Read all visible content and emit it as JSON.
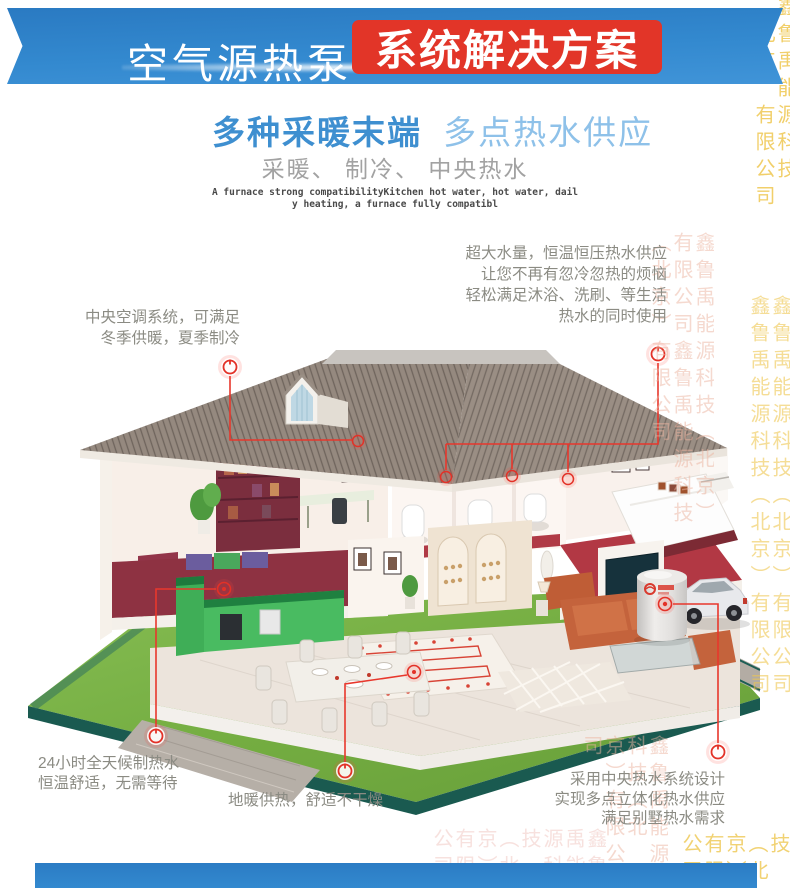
{
  "banner": {
    "title_thin": "空气源热泵",
    "title_badge": "系统解决方案"
  },
  "heading": {
    "line1_bold": "多种采暖末端",
    "line1_light": "多点热водs供应",
    "line2": "采暖、 制冷、 中央热水",
    "english_line1": "A furnace strong compatibilityKitchen hot water, hot water, dail",
    "english_line2": "y heating, a furnace fully compatibl"
  },
  "callouts": {
    "hot_water_supply": {
      "lines": [
        "超大水量，恒温恒压热水供应",
        "让您不再有忽冷忽热的烦恼",
        "轻松满足沐浴、洗刷、等生活",
        "热水的同时使用"
      ]
    },
    "central_ac": {
      "lines": [
        "中央空调系统，可满足",
        "冬季供暖，夏季制冷"
      ]
    },
    "all_day_hot_water": {
      "lines": [
        "24小时全天候制热水",
        "恒温舒适，无需等待"
      ]
    },
    "floor_heating": {
      "lines": [
        "地暖供热，舒适不干燥"
      ]
    },
    "central_hot_water_design": {
      "lines": [
        "采用中央热水系统设计",
        "实现多点立体化热水供应",
        "满足别墅热水需求"
      ]
    }
  },
  "watermark": {
    "company": "鑫鲁禹能源科技（北京）有限公司",
    "company_repeated": "鑫鲁禹能源科技（北京）有限公司鑫鲁禹能源科技（北京）有限公司"
  },
  "colors": {
    "banner_blue": "#3389cf",
    "badge_red": "#e23528",
    "heading_blue": "#3e8fd0",
    "heading_light_blue": "#8ec1e9",
    "text_gray": "#8b8b83",
    "marker_red": "#e33127",
    "lawn_green": "#7ab648",
    "roof_brown": "#95897f",
    "watermark_yellow": "#f0cd55"
  }
}
